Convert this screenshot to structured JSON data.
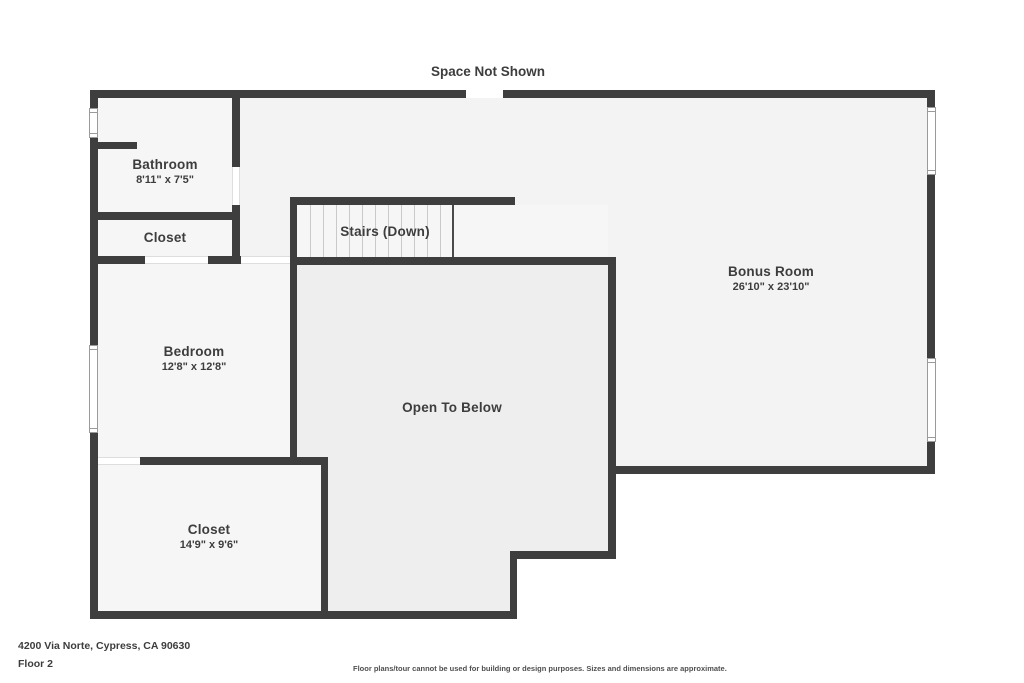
{
  "title": "Space Not Shown",
  "rooms": {
    "bathroom": {
      "name": "Bathroom",
      "dims": "8'11\" x 7'5\""
    },
    "closet_top": {
      "name": "Closet"
    },
    "stairs": {
      "name": "Stairs (Down)"
    },
    "bonus": {
      "name": "Bonus Room",
      "dims": "26'10\" x 23'10\""
    },
    "bedroom": {
      "name": "Bedroom",
      "dims": "12'8\" x 12'8\""
    },
    "open_below": {
      "name": "Open To Below"
    },
    "closet_bottom": {
      "name": "Closet",
      "dims": "14'9\" x 9'6\""
    }
  },
  "footer": {
    "address": "4200 Via Norte, Cypress, CA 90630",
    "floor": "Floor 2",
    "disclaimer": "Floor plans/tour cannot be used for building or design purposes. Sizes and dimensions are approximate."
  },
  "colors": {
    "wall": "#3e3e3e",
    "room-fill": "#f6f6f6",
    "bonus-fill": "#f3f3f3",
    "open-fill": "#eeeeee",
    "text": "#3d3d3d",
    "tread": "#c9c9c9",
    "window-border": "#9a9a9a"
  }
}
